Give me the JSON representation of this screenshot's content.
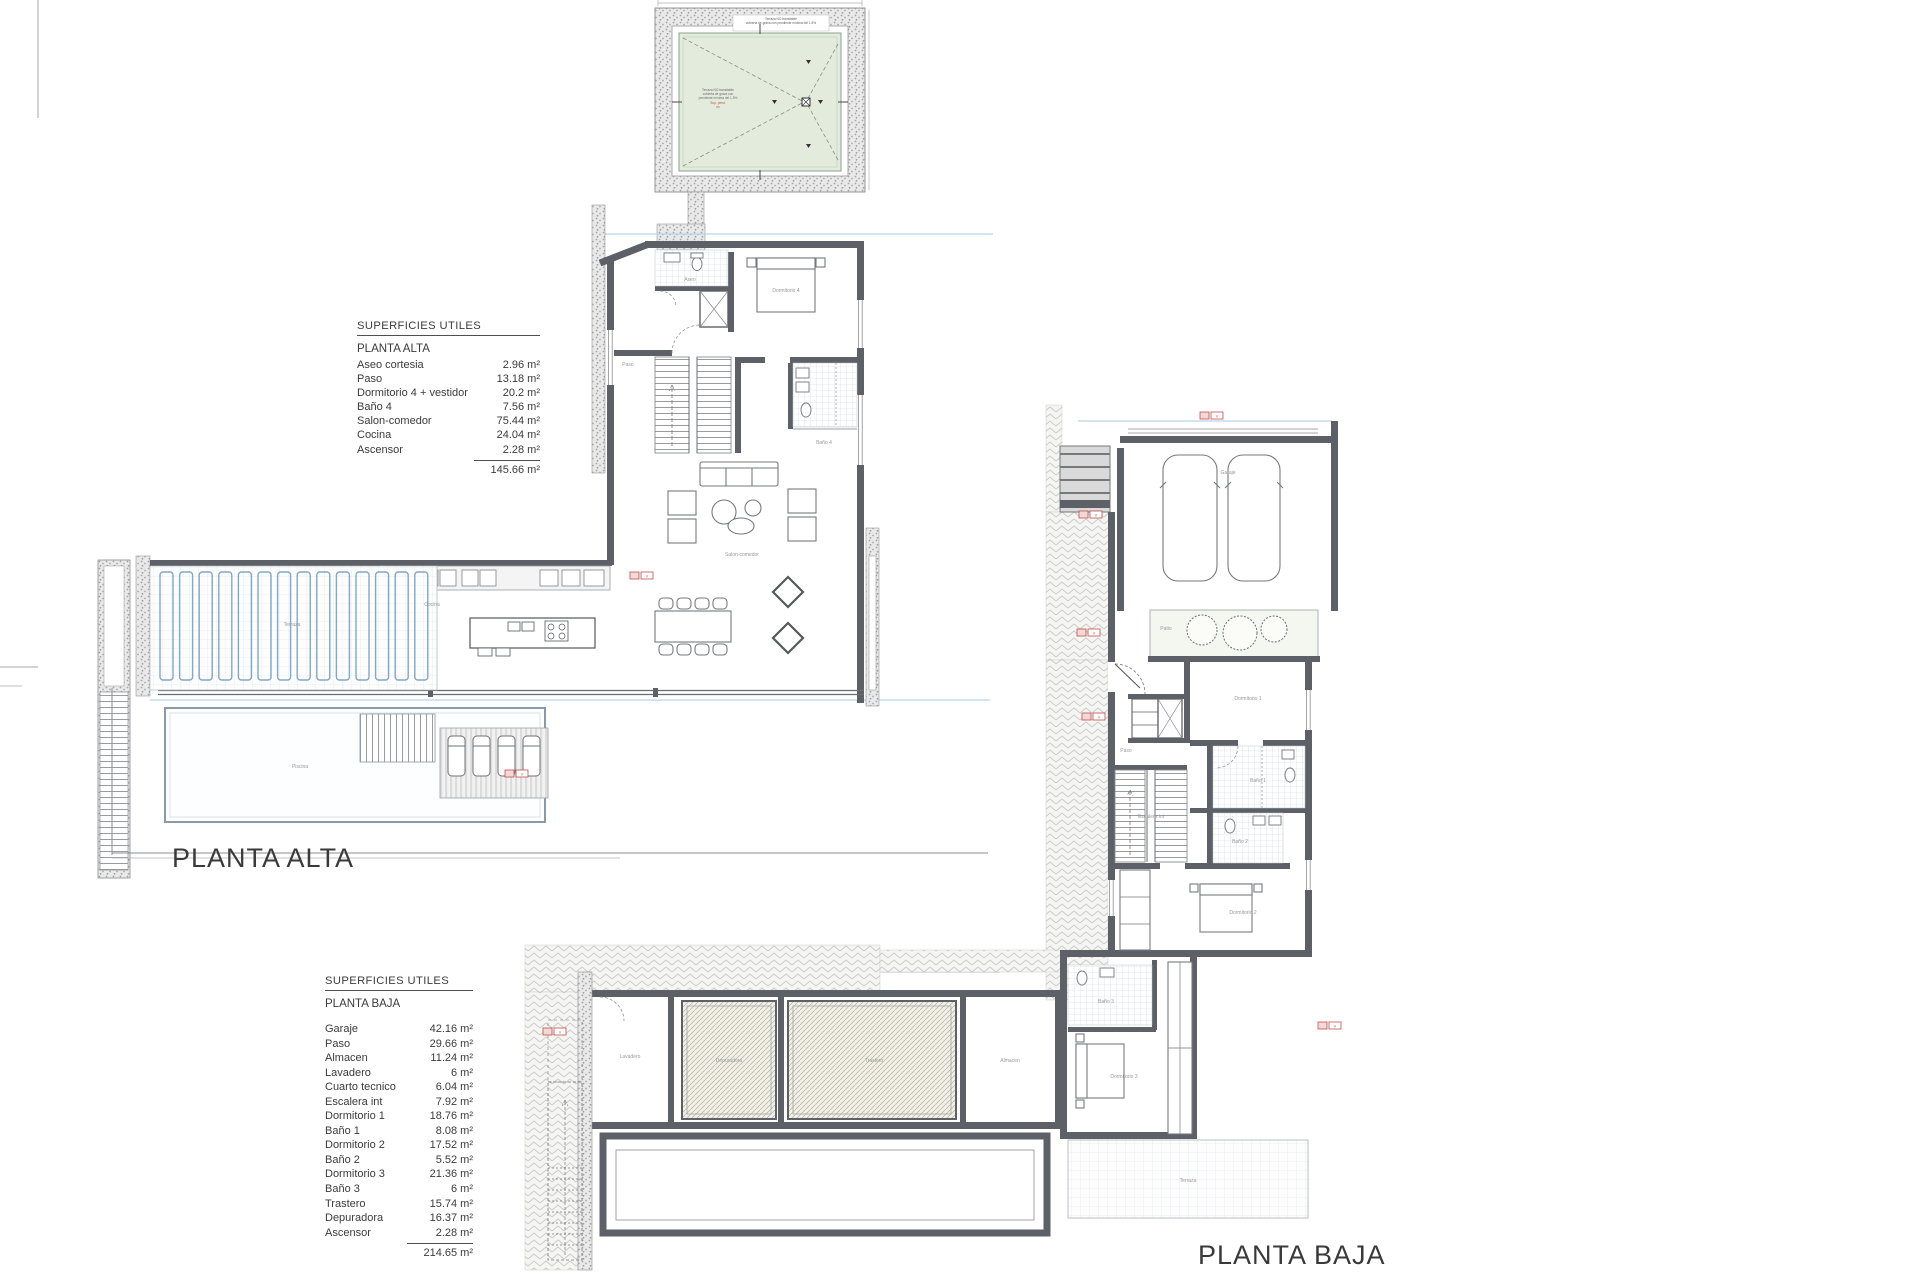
{
  "floor_labels": {
    "alta": "PLANTA ALTA",
    "baja": "PLANTA BAJA"
  },
  "tables": {
    "alta": {
      "header": "SUPERFICIES UTILES",
      "floor": "PLANTA ALTA",
      "rows": [
        {
          "label": "Aseo cortesia",
          "value": "2.96 m²"
        },
        {
          "label": "Paso",
          "value": "13.18 m²"
        },
        {
          "label": "Dormitorio 4 + vestidor",
          "value": "20.2 m²"
        },
        {
          "label": "Baño 4",
          "value": "7.56 m²"
        },
        {
          "label": "Salon-comedor",
          "value": "75.44 m²"
        },
        {
          "label": "Cocina",
          "value": "24.04 m²"
        },
        {
          "label": "Ascensor",
          "value": "2.28 m²"
        }
      ],
      "total": "145.66 m²"
    },
    "baja": {
      "header": "SUPERFICIES UTILES",
      "floor": "PLANTA BAJA",
      "rows": [
        {
          "label": "Garaje",
          "value": "42.16 m²"
        },
        {
          "label": "Paso",
          "value": "29.66 m²"
        },
        {
          "label": "Almacen",
          "value": "11.24 m²"
        },
        {
          "label": "Lavadero",
          "value": "6 m²"
        },
        {
          "label": "Cuarto tecnico",
          "value": "6.04 m²"
        },
        {
          "label": "Escalera int",
          "value": "7.92 m²"
        },
        {
          "label": "Dormitorio 1",
          "value": "18.76 m²"
        },
        {
          "label": "Baño 1",
          "value": "8.08 m²"
        },
        {
          "label": "Dormitorio 2",
          "value": "17.52 m²"
        },
        {
          "label": "Baño 2",
          "value": "5.52 m²"
        },
        {
          "label": "Dormitorio 3",
          "value": "21.36 m²"
        },
        {
          "label": "Baño 3",
          "value": "6 m²"
        },
        {
          "label": "Trastero",
          "value": "15.74 m²"
        },
        {
          "label": "Depuradora",
          "value": "16.37 m²"
        },
        {
          "label": "Ascensor",
          "value": "2.28 m²"
        }
      ],
      "total": "214.65 m²"
    }
  },
  "roof_detail": {
    "top_label_line1": "Terraza NO transitable",
    "top_label_line2": "cubierta de grava con pendiente mínima del 1.5%",
    "center_lines": [
      "Terraza NO transitable",
      "cubierta de grava con",
      "pendiente mínima del 1.5%"
    ],
    "red_lines": [
      "Sup. pend.",
      "m²"
    ]
  },
  "plans": {
    "alta": {
      "room_labels": [
        {
          "t": "Aseo",
          "x": 690,
          "y": 281
        },
        {
          "t": "Dormitorio 4",
          "x": 786,
          "y": 292
        },
        {
          "t": "Paso",
          "x": 628,
          "y": 366
        },
        {
          "t": "Baño 4",
          "x": 824,
          "y": 444
        },
        {
          "t": "Salon-comedor",
          "x": 742,
          "y": 556
        },
        {
          "t": "Cocina",
          "x": 432,
          "y": 606
        },
        {
          "t": "Terraza",
          "x": 292,
          "y": 626
        },
        {
          "t": "Piscina",
          "x": 300,
          "y": 768
        }
      ]
    },
    "baja": {
      "room_labels": [
        {
          "t": "Garaje",
          "x": 1228,
          "y": 474
        },
        {
          "t": "Patio",
          "x": 1166,
          "y": 630
        },
        {
          "t": "Paso",
          "x": 1126,
          "y": 752
        },
        {
          "t": "Dormitorio 1",
          "x": 1248,
          "y": 700
        },
        {
          "t": "Baño 1",
          "x": 1258,
          "y": 782
        },
        {
          "t": "Baño 2",
          "x": 1240,
          "y": 843
        },
        {
          "t": "Dormitorio 2",
          "x": 1243,
          "y": 914
        },
        {
          "t": "Escalera int",
          "x": 1151,
          "y": 818
        },
        {
          "t": "Baño 3",
          "x": 1106,
          "y": 1003
        },
        {
          "t": "Dormitorio 3",
          "x": 1124,
          "y": 1078
        },
        {
          "t": "Almacen",
          "x": 1010,
          "y": 1062
        },
        {
          "t": "Trastero",
          "x": 874,
          "y": 1062
        },
        {
          "t": "Depuradora",
          "x": 729,
          "y": 1062
        },
        {
          "t": "Lavadero",
          "x": 630,
          "y": 1058
        },
        {
          "t": "Terraza",
          "x": 1188,
          "y": 1182
        }
      ]
    }
  },
  "tags": {
    "text": "V"
  },
  "colors": {
    "wall": "#5d6066",
    "thin_line": "#8a8d90",
    "louver_blue": "#7fa8c9",
    "section_blue": "#b9d3e6",
    "roof_green_fill": "#e3ecdc",
    "roof_green_border": "#8fa28f",
    "tag_red": "#c0504d",
    "hatch": "#b6b29c"
  }
}
